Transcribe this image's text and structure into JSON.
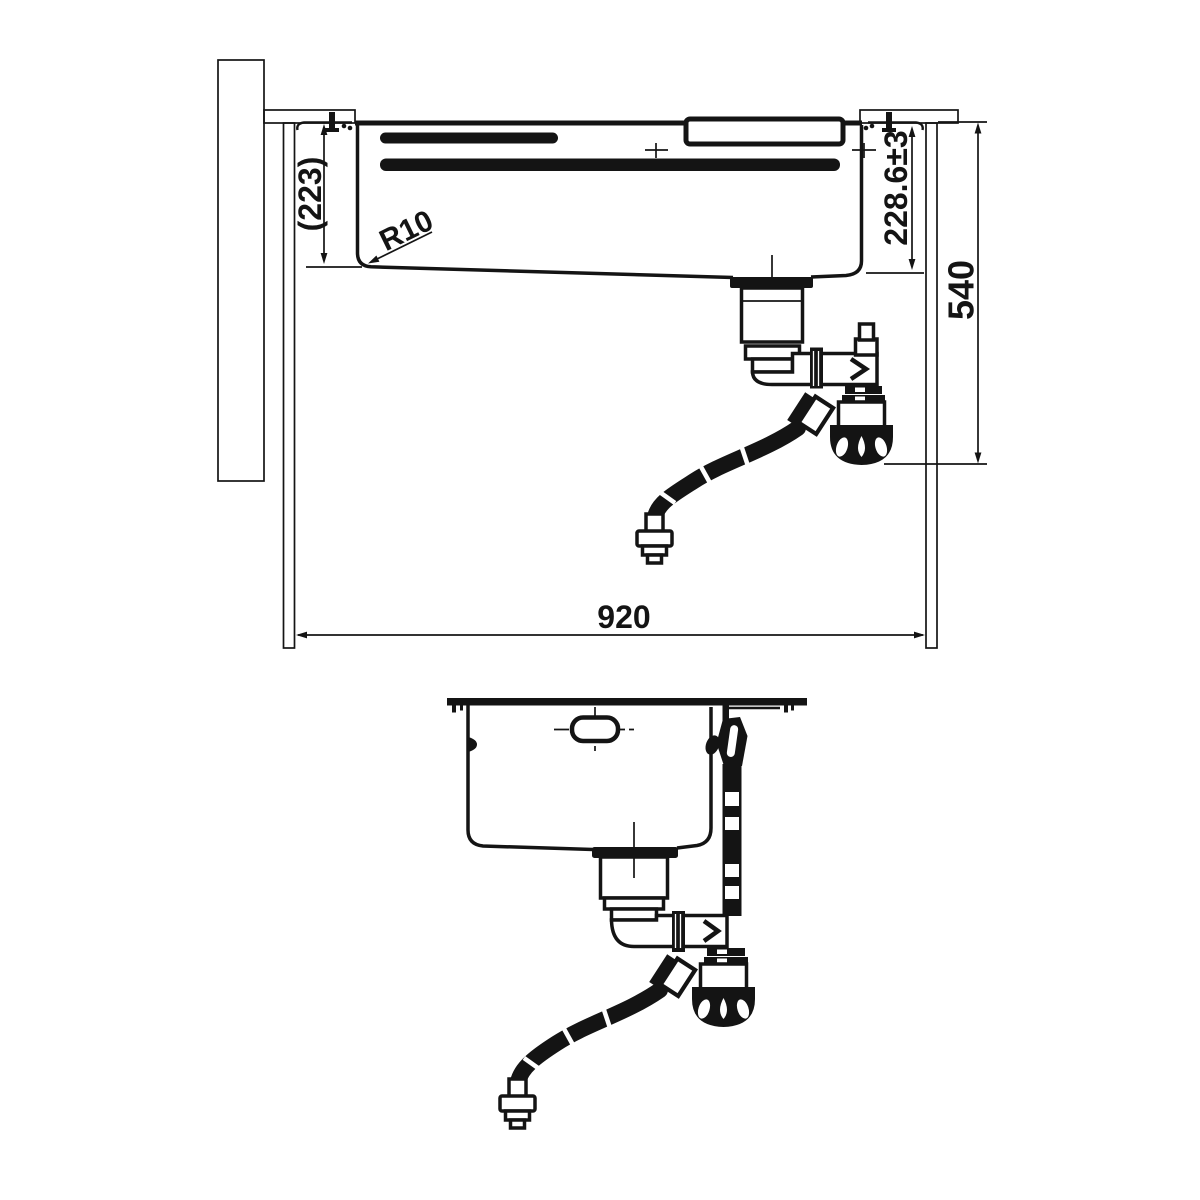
{
  "drawing": {
    "background": "#ffffff",
    "ink": "#141414",
    "dimensions": {
      "bowl_depth_outer": "(223)",
      "bottom_radius": "R10",
      "bowl_depth_inner": "228.6±3",
      "install_height": "540",
      "cabinet_width": "920"
    }
  }
}
